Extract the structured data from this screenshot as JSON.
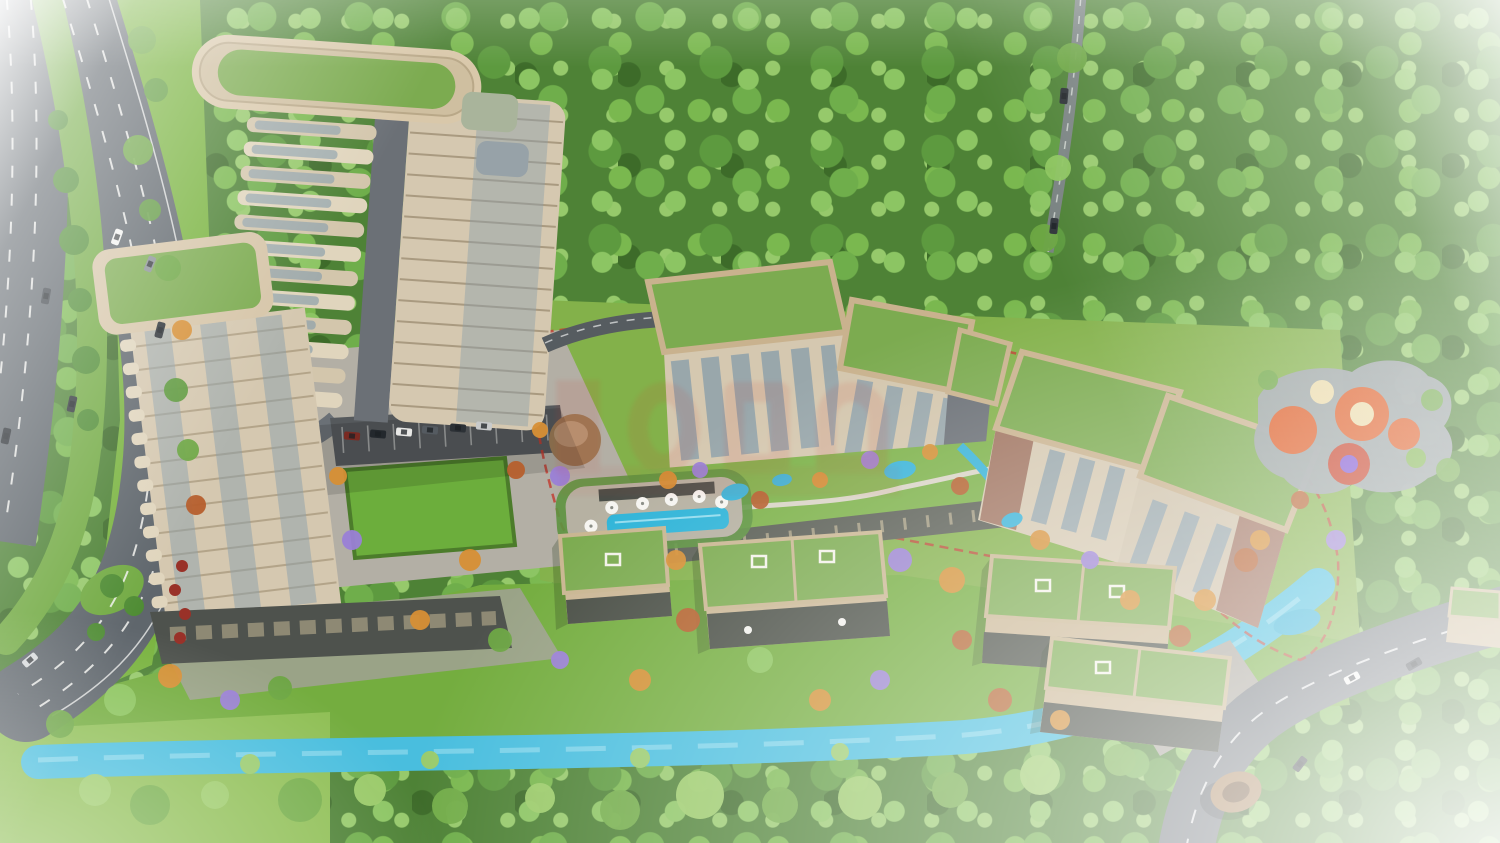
{
  "scene": {
    "description": "Aerial 3D architectural rendering of a residential complex beside dense forest: two high-rise green-roof towers, mid-rise apartment blocks, a villa row, pool deck, playground, blue canal, multi-lane highway and curved access road",
    "palette": {
      "forest_base": "#4e8236",
      "lawn_bright": "#79b33f",
      "lawn_mid": "#74ad3f",
      "terrace_green": "#83b14a",
      "plaza": "#b3afa5",
      "parking": "#55595c",
      "asphalt_dark": "#5f666c",
      "asphalt_light": "#70767c",
      "median_green": "#72aa43",
      "canal_blue": "#49bede",
      "pool_blue": "#2fb4d8",
      "pond_blue": "#38b3d8",
      "roof_green": "#7cab50",
      "roof_trim": "#c9b28e",
      "facade_beige": "#d5c8b0",
      "facade_light": "#e0d5bd",
      "facade_line": "#a99a80",
      "glass": "#8ba0ab",
      "core_gray": "#6b7076",
      "brick": "#9a6a58",
      "storefront_dark": "#4e524d",
      "deck": "#b6b1a2",
      "pergola": "#4a4e48",
      "playground_pad": "#9aa1a4",
      "playground_orange": "#dd5a22",
      "playground_red": "#c53b22",
      "playground_purple": "#7b4fd0",
      "playground_cream": "#ead9a6",
      "kiosk_brown": "#a8835a",
      "kiosk_inner": "#6f5236",
      "umbrella_red": "#993128",
      "route_red": "#c23a2e",
      "watermark_red": "#d23b2f",
      "tree_colors": [
        "#8cc55e",
        "#6da743",
        "#d78f35",
        "#b65f2d",
        "#9a7fd6",
        "#5e9a3d"
      ],
      "canal_tree_colors": [
        "#9ccb6a",
        "#74ad4a"
      ]
    },
    "towers": {
      "tower1": {
        "floors": 15,
        "left_bars": 13
      },
      "tower2": {
        "floors": 12,
        "left_tabs": 12
      }
    },
    "trees": [
      [
        142,
        40,
        14,
        1
      ],
      [
        156,
        90,
        12,
        5
      ],
      [
        138,
        150,
        15,
        1
      ],
      [
        150,
        210,
        11,
        5
      ],
      [
        168,
        268,
        13,
        1
      ],
      [
        182,
        330,
        10,
        2
      ],
      [
        176,
        390,
        12,
        5
      ],
      [
        188,
        450,
        11,
        1
      ],
      [
        196,
        505,
        10,
        3
      ],
      [
        120,
        700,
        16,
        0
      ],
      [
        170,
        676,
        12,
        2
      ],
      [
        60,
        724,
        14,
        1
      ],
      [
        230,
        700,
        10,
        4
      ],
      [
        280,
        688,
        12,
        1
      ],
      [
        338,
        476,
        9,
        2
      ],
      [
        352,
        540,
        10,
        4
      ],
      [
        470,
        560,
        11,
        2
      ],
      [
        516,
        470,
        9,
        3
      ],
      [
        540,
        430,
        8,
        2
      ],
      [
        560,
        476,
        10,
        4
      ],
      [
        668,
        480,
        9,
        2
      ],
      [
        700,
        470,
        8,
        4
      ],
      [
        760,
        500,
        9,
        3
      ],
      [
        820,
        480,
        8,
        2
      ],
      [
        870,
        460,
        9,
        4
      ],
      [
        930,
        452,
        8,
        2
      ],
      [
        960,
        486,
        9,
        3
      ],
      [
        676,
        560,
        10,
        2
      ],
      [
        688,
        620,
        12,
        3
      ],
      [
        900,
        560,
        12,
        4
      ],
      [
        952,
        580,
        13,
        2
      ],
      [
        962,
        640,
        10,
        3
      ],
      [
        1205,
        600,
        11,
        2
      ],
      [
        1246,
        560,
        12,
        3
      ],
      [
        1040,
        540,
        10,
        2
      ],
      [
        1090,
        560,
        9,
        4
      ],
      [
        1130,
        600,
        10,
        2
      ],
      [
        1180,
        636,
        11,
        3
      ],
      [
        1260,
        540,
        10,
        2
      ],
      [
        1300,
        500,
        9,
        3
      ],
      [
        1336,
        540,
        10,
        4
      ],
      [
        1268,
        380,
        10,
        1
      ],
      [
        1432,
        400,
        11,
        1
      ],
      [
        1448,
        470,
        12,
        1
      ],
      [
        420,
        620,
        10,
        2
      ],
      [
        500,
        640,
        12,
        1
      ],
      [
        560,
        660,
        9,
        4
      ],
      [
        640,
        680,
        11,
        2
      ],
      [
        760,
        660,
        13,
        0
      ],
      [
        820,
        700,
        11,
        2
      ],
      [
        880,
        680,
        10,
        4
      ],
      [
        1000,
        700,
        12,
        3
      ],
      [
        1060,
        720,
        10,
        2
      ],
      [
        1072,
        58,
        15,
        1
      ],
      [
        1058,
        168,
        13,
        0
      ],
      [
        1044,
        238,
        14,
        1
      ]
    ],
    "canal_trees": [
      [
        95,
        790,
        16,
        0
      ],
      [
        150,
        805,
        20,
        1
      ],
      [
        215,
        795,
        14,
        0
      ],
      [
        300,
        800,
        22,
        1
      ],
      [
        370,
        790,
        16,
        0
      ],
      [
        450,
        806,
        18,
        1
      ],
      [
        540,
        798,
        15,
        0
      ],
      [
        620,
        810,
        20,
        1
      ],
      [
        700,
        795,
        24,
        0
      ],
      [
        780,
        805,
        18,
        1
      ],
      [
        860,
        798,
        22,
        0
      ],
      [
        950,
        790,
        18,
        1
      ],
      [
        1040,
        775,
        20,
        0
      ],
      [
        1120,
        760,
        16,
        1
      ],
      [
        1190,
        740,
        14,
        0
      ],
      [
        250,
        764,
        10,
        0
      ],
      [
        430,
        760,
        9,
        0
      ],
      [
        640,
        758,
        10,
        0
      ],
      [
        840,
        752,
        9,
        0
      ]
    ],
    "median_trees": [
      [
        58,
        120,
        10
      ],
      [
        66,
        180,
        13
      ],
      [
        74,
        240,
        15
      ],
      [
        80,
        300,
        12
      ],
      [
        86,
        360,
        14
      ],
      [
        88,
        420,
        11
      ],
      [
        112,
        586,
        12
      ],
      [
        134,
        606,
        10
      ],
      [
        96,
        632,
        9
      ]
    ],
    "cars": [
      [
        72,
        404,
        -78,
        "#2e3338"
      ],
      [
        46,
        296,
        -80,
        "#3a4046"
      ],
      [
        6,
        436,
        -78,
        "#23282d"
      ],
      [
        117,
        237,
        -70,
        "#f2f2f0"
      ],
      [
        150,
        264,
        -68,
        "#8a9096"
      ],
      [
        160,
        330,
        -75,
        "#2e3338"
      ],
      [
        30,
        660,
        -40,
        "#d7dadc"
      ],
      [
        1064,
        96,
        -85,
        "#2c3136"
      ],
      [
        1054,
        226,
        -84,
        "#33383d"
      ],
      [
        1352,
        678,
        -28,
        "#f4f4f2"
      ],
      [
        1414,
        664,
        -30,
        "#3a4046"
      ],
      [
        1300,
        764,
        -52,
        "#2c3136"
      ],
      [
        352,
        436,
        5,
        "#7a2a22"
      ],
      [
        378,
        434,
        5,
        "#23282d"
      ],
      [
        404,
        432,
        5,
        "#e8e8e6"
      ],
      [
        430,
        430,
        5,
        "#555b61"
      ],
      [
        458,
        428,
        5,
        "#2c3136"
      ],
      [
        484,
        426,
        5,
        "#c8cacb"
      ]
    ],
    "umbrellas_pool": [
      [
        590,
        522
      ],
      [
        612,
        505
      ],
      [
        643,
        503
      ],
      [
        672,
        501
      ],
      [
        700,
        500
      ],
      [
        722,
        507
      ]
    ],
    "umbrellas_cafe": [
      [
        182,
        566
      ],
      [
        175,
        590
      ],
      [
        185,
        614
      ],
      [
        180,
        638
      ]
    ],
    "playground_circles": [
      [
        1293,
        430,
        24,
        "playground_orange"
      ],
      [
        1362,
        414,
        27,
        "playground_orange"
      ],
      [
        1362,
        414,
        12,
        "playground_cream"
      ],
      [
        1349,
        464,
        21,
        "playground_red"
      ],
      [
        1349,
        464,
        9,
        "playground_purple"
      ],
      [
        1322,
        392,
        12,
        "playground_cream"
      ],
      [
        1404,
        434,
        16,
        "playground_orange"
      ]
    ],
    "ponds": [
      [
        735,
        492,
        14,
        8,
        -15
      ],
      [
        782,
        480,
        10,
        6,
        -10
      ],
      [
        900,
        470,
        16,
        9,
        -10
      ],
      [
        1012,
        520,
        11,
        7,
        -20
      ],
      [
        1058,
        601,
        13,
        7,
        -15
      ],
      [
        1297,
        622,
        24,
        12,
        -15
      ]
    ]
  }
}
